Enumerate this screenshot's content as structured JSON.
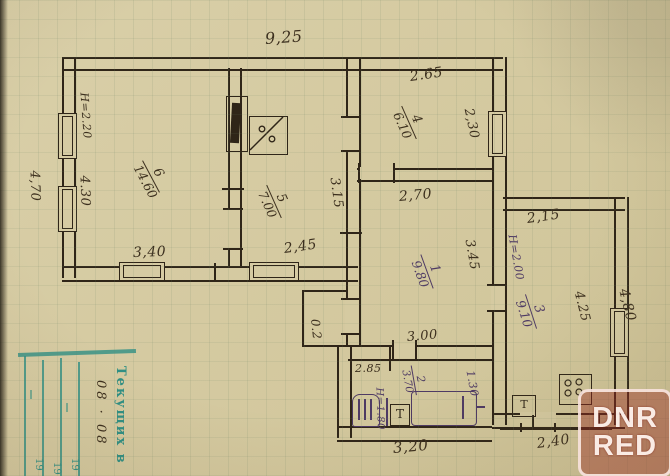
{
  "palette": {
    "paper": "#d5caa1",
    "ink": "#2f2518",
    "violet_ink": "#4e3a64",
    "stamp_teal": "#2f8f84",
    "watermark_red": "#9e2c26"
  },
  "watermark": {
    "line1": "DNR",
    "line2": "RED"
  },
  "stamp": {
    "title": "Текущих в",
    "note": "08 · 08",
    "years": [
      "19",
      "19",
      "19"
    ]
  },
  "rooms": {
    "r6": {
      "number": "6",
      "area": "14.60"
    },
    "r5": {
      "number": "5",
      "area": "7.00"
    },
    "r4": {
      "number": "4",
      "area": "6.10"
    },
    "r1": {
      "number": "1",
      "area": "9.80"
    },
    "r3": {
      "number": "3",
      "area": "9.10"
    },
    "r2": {
      "number": "2",
      "area": "3.70"
    }
  },
  "dims": {
    "top_width": "9,25",
    "left_outer": "4,70",
    "left_inner": "4.30",
    "room6_height": "H=2.20",
    "room6_bottom": "3,40",
    "room5_bottom": "2,45",
    "room5_right": "3.15",
    "room4_top": "2.65",
    "room4_right": "2,30",
    "room1_top": "2,70",
    "room1_left": "3.45",
    "room1_bottom": "3.00",
    "step": "0.2",
    "room3_top": "2,15",
    "room3_height": "H=2.00",
    "room3_right_inner": "4.25",
    "room3_right_outer": "4,80",
    "room2_left": "2.85",
    "room2_height": "H=1.80",
    "room2_right": "1.30",
    "room2_bottom": "3,20",
    "porch_bottom": "2,40"
  },
  "fixtures": {
    "heating_stove": "stove with flue (room 5)",
    "boiler": "boiler (room 2)",
    "small_stove": "T",
    "bathtub": "bathtub (room 2)",
    "gas_stove": "gas stove (room 3)",
    "washstand": "T"
  }
}
